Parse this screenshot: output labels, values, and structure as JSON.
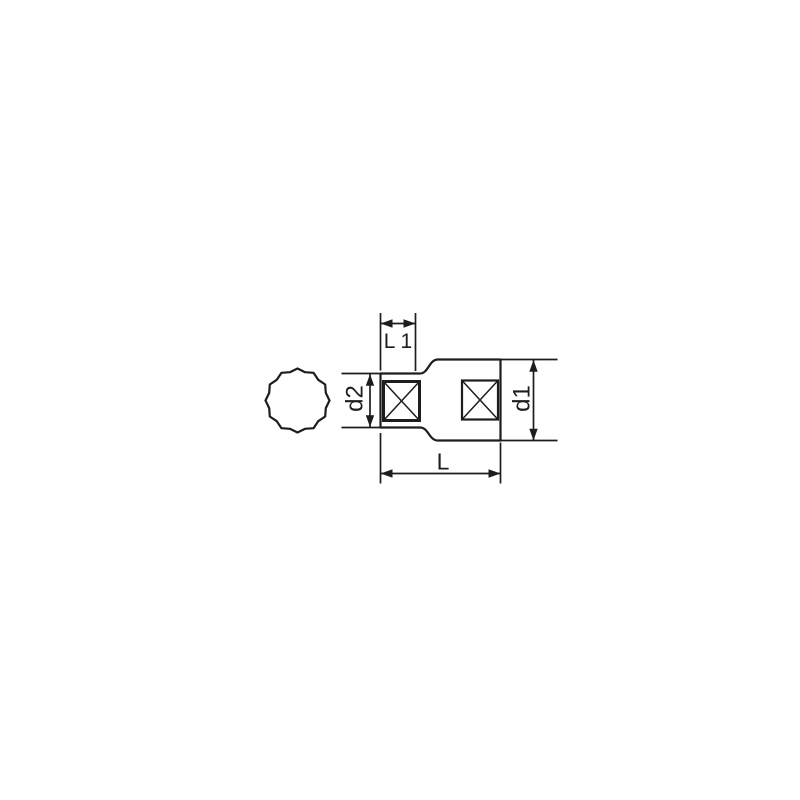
{
  "page": {
    "background_color": "#ffffff"
  },
  "drawing": {
    "kind": "technical-dimension-drawing",
    "subject": "12-point socket",
    "line_color": "#1d1d1b",
    "views": {
      "end_view_icon": "twelve-point-profile-icon",
      "side_view_icon": "socket-side-view-outline"
    },
    "labels": {
      "l1": "L 1",
      "d2": "d2",
      "d1": "d1",
      "l": "L"
    }
  }
}
